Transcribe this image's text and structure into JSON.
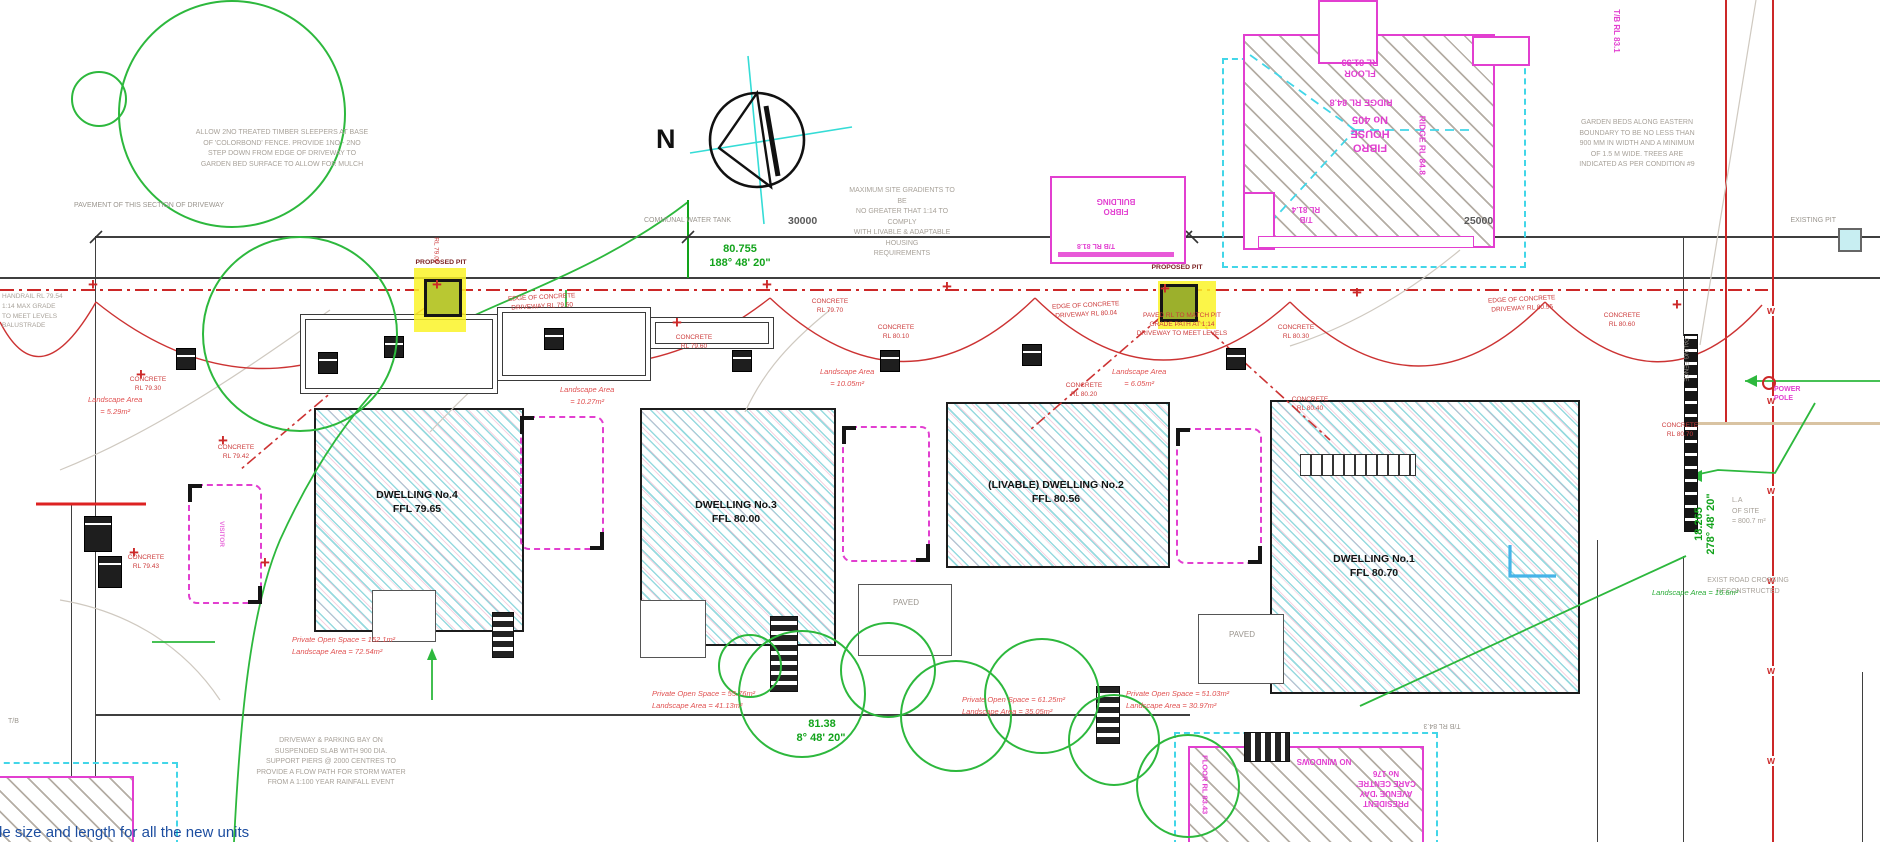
{
  "caption": "de size and length for all the new units",
  "compass": {
    "north": "N"
  },
  "dims": {
    "front_length": "80.755",
    "front_bearing": "188° 48' 20\"",
    "rear_length": "81.38",
    "rear_bearing": "8° 48' 20\"",
    "east_length": "18.265",
    "east_bearing": "278° 48' 20\"",
    "lot_width_1": "30000",
    "lot_width_2": "25000"
  },
  "street": {
    "communal_water_tank": "COMMUNAL WATER TANK",
    "proposed_pit": "PROPOSED PIT",
    "existing_pit": "EXISTING PIT"
  },
  "notes": {
    "sleepers": [
      "ALLOW 2NO TREATED TIMBER SLEEPERS AT BASE",
      "OF 'COLORBOND' FENCE. PROVIDE 1NO - 2NO",
      "STEP DOWN FROM EDGE OF DRIVEWAY TO",
      "GARDEN BED SURFACE TO ALLOW FOR MULCH"
    ],
    "driveway_section": "PAVEMENT OF THIS SECTION OF DRIVEWAY",
    "gradients": [
      "MAXIMUM SITE GRADIENTS TO BE",
      "NO GREATER THAT 1:14 TO COMPLY",
      "WITH LIVABLE & ADAPTABLE HOUSING",
      "REQUIREMENTS"
    ],
    "garden_beds": [
      "GARDEN BEDS ALONG EASTERN",
      "BOUNDARY TO BE NO LESS THAN",
      "900 MM IN WIDTH AND A MINIMUM",
      "OF 1.5 M WIDE. TREES ARE",
      "INDICATED AS PER CONDITION #9"
    ],
    "suspended_slab": [
      "DRIVEWAY & PARKING BAY ON",
      "SUSPENDED SLAB WITH 900 DIA.",
      "SUPPORT PIERS @ 2000 CENTRES TO",
      "PROVIDE A FLOW PATH FOR STORM WATER",
      "FROM A 1:100 YEAR RAINFALL EVENT"
    ],
    "road_crossing": [
      "EXIST ROAD CROSSING",
      "RECONSTRUCTED"
    ],
    "site_area": [
      "L.A",
      "OF SITE",
      "= 800.7 m²"
    ],
    "handrail": [
      "HANDRAIL RL 79.54",
      "1:14 MAX GRADE",
      "TO MEET LEVELS",
      "BALUSTRADE"
    ],
    "tb_sw": "T/B"
  },
  "dwellings": [
    {
      "name": "DWELLING No.4",
      "ffl": "FFL 79.65"
    },
    {
      "name": "DWELLING No.3",
      "ffl": "FFL 80.00"
    },
    {
      "name": "(LIVABLE) DWELLING No.2",
      "ffl": "FFL 80.56"
    },
    {
      "name": "DWELLING No.1",
      "ffl": "FFL 80.70"
    }
  ],
  "neighbours": {
    "fibro_house": {
      "name": [
        "FIBRO",
        "HOUSE",
        "No 405"
      ],
      "floor": [
        "FLOOR",
        "RL 81.33"
      ],
      "ridge": "RIDGE RL 84.8",
      "ridge_side": "RIDGE RL 84.8",
      "tb": [
        "T/B",
        "RL 81.4"
      ],
      "tb_ne": "T/B RL 83.1"
    },
    "fibro_building": {
      "name": [
        "FIBRO",
        "BUILDING"
      ],
      "rl": "T/B RL 81.8"
    },
    "day_care": {
      "no_windows": "NO WINDOWS",
      "name": [
        "PRESIDENT",
        "AVENUE 'DAY",
        "CARE CENTRE'",
        "No 176"
      ],
      "floor": "FLOOR RL 83.43",
      "tb": "T/B RL 84.3"
    }
  },
  "areas": {
    "d4": [
      "Private Open Space = 152.1m²",
      "Landscape Area = 72.54m²"
    ],
    "d3": [
      "Private Open Space = 55.76m²",
      "Landscape Area = 41.13m²"
    ],
    "d2": [
      "Private Open Space = 61.25m²",
      "Landscape Area = 35.05m²"
    ],
    "d1": [
      "Private Open Space = 51.03m²",
      "Landscape Area = 30.97m²"
    ],
    "ls1": [
      "Landscape Area",
      "= 5.29m²"
    ],
    "ls2": [
      "Landscape Area",
      "= 10.27m²"
    ],
    "ls3": [
      "Landscape Area",
      "= 10.05m²"
    ],
    "ls4": [
      "Landscape Area",
      "= 6.05m²"
    ],
    "ls_east": "Landscape Area = 16.6m²"
  },
  "red_labels": [
    {
      "lines": [
        "EDGE OF CONCRETE",
        "DRIVEWAY RL 79.50"
      ]
    },
    {
      "lines": [
        "CONCRETE",
        "RL 79.70"
      ]
    },
    {
      "lines": [
        "EDGE OF CONCRETE",
        "DRIVEWAY RL 80.04"
      ]
    },
    {
      "lines": [
        "EDGE OF CONCRETE",
        "DRIVEWAY RL 80.55"
      ]
    },
    {
      "lines": [
        "CONCRETE",
        "RL 79.42"
      ]
    },
    {
      "lines": [
        "CONCRETE",
        "RL 79.43"
      ]
    },
    {
      "lines": [
        "CONCRETE",
        "RL 79.30"
      ]
    },
    {
      "lines": [
        "CONCRETE",
        "RL 79.60"
      ]
    },
    {
      "lines": [
        "CONCRETE",
        "RL 80.10"
      ]
    },
    {
      "lines": [
        "CONCRETE",
        "RL 80.20"
      ]
    },
    {
      "lines": [
        "CONCRETE",
        "RL 80.30"
      ]
    },
    {
      "lines": [
        "CONCRETE",
        "RL 80.40"
      ]
    },
    {
      "lines": [
        "CONCRETE",
        "RL 80.60"
      ]
    },
    {
      "lines": [
        "CONCRETE",
        "RL 80.70"
      ]
    },
    {
      "lines": [
        "PAVED RL TO MATCH PIT",
        "GRADE PATH AT 1:14",
        "DRIVEWAY TO MEET LEVELS"
      ]
    },
    {
      "lines": [
        "RL 79.05"
      ]
    }
  ],
  "misc": {
    "power_pole": [
      "POWER",
      "POLE"
    ],
    "paling_fence": "PALING FENCE",
    "visitor": "VISITOR",
    "paved": "PAVED",
    "w_marker": "W",
    "colors": {
      "boundary_red": "#cc2828",
      "dwelling_hatch": "#97dadf",
      "neighbour_magenta": "#e23fd0",
      "roof_cyan": "#42d6e8",
      "dim_green": "#12a31b",
      "note_gray": "#a8a29a",
      "pit_fill": "#b9c832",
      "pit_highlight": "#faf328"
    }
  }
}
